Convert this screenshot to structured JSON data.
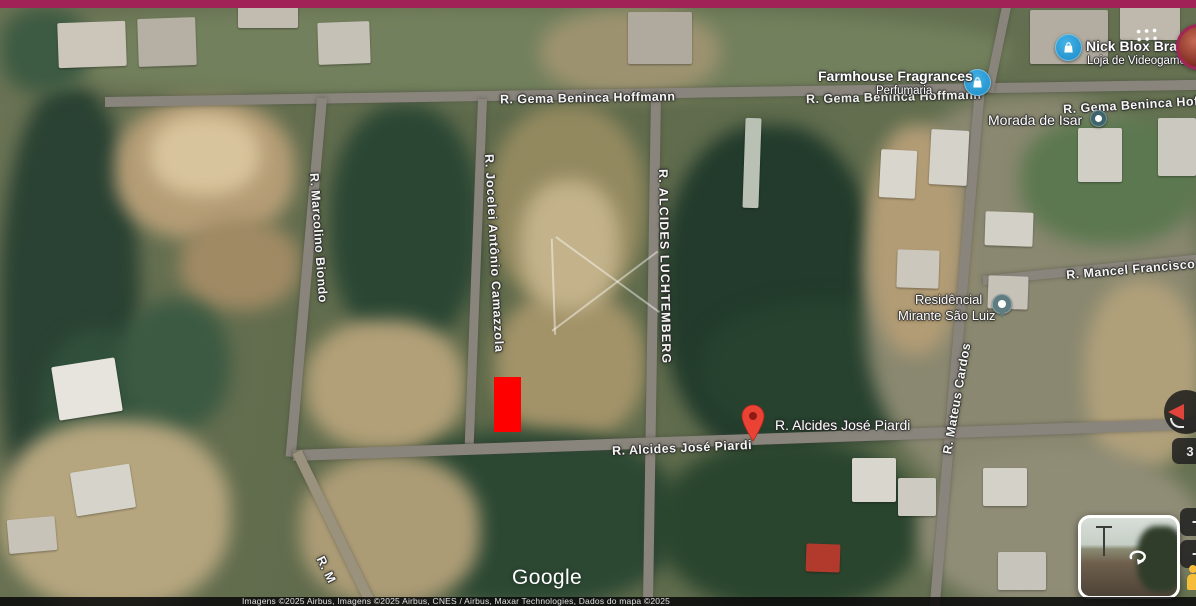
{
  "colors": {
    "top_bar": "#a12257",
    "highlight_lot": "#ff0000",
    "marker_red": "#ea4335",
    "poi_icon_blue": "#2fa2db",
    "attribution_bg": "#0a0a0a"
  },
  "streets": {
    "gema_center": "R. Gema Beninca Hoffmann",
    "gema_right": "R. Gema Beninca Hoffmann",
    "gema_far_right": "R. Gema Beninca Hoffmann",
    "jocelei": "R. Jocelei Antônio Camazzola",
    "luchtemberg": "R. ALCIDES LUCHTEMBERG",
    "marcolino": "R. Marcolino Biondo",
    "piardi": "R. Alcides José Piardi",
    "mateus": "R. Mateus Cardos",
    "mancel": "R. Mancel Francisco d",
    "bottom_partial": "R. M"
  },
  "pois": {
    "nick_blox": {
      "title": "Nick Blox Brasil",
      "subtitle": "Loja de Videogame",
      "icon": "shopping-bag"
    },
    "farmhouse": {
      "title": "Farmhouse Fragrances",
      "subtitle": "Perfumaria",
      "icon": "shopping-bag"
    },
    "morada": {
      "title": "Morada de Isar",
      "icon": "poi-dot"
    },
    "residencial": {
      "line1": "Residêncial",
      "line2": "Mirante São Luiz",
      "icon": "poi-pin"
    }
  },
  "marker": {
    "label": "R. Alcides José Piardi"
  },
  "branding": {
    "logo_text": "Google"
  },
  "attribution": {
    "line": "Imagens ©2025 Airbus, Imagens ©2025 Airbus, CNES / Airbus, Maxar Technologies, Dados do mapa ©2025"
  },
  "controls": {
    "zoom_in_label": "+",
    "zoom_out_label": "−",
    "scale_label": "3"
  }
}
